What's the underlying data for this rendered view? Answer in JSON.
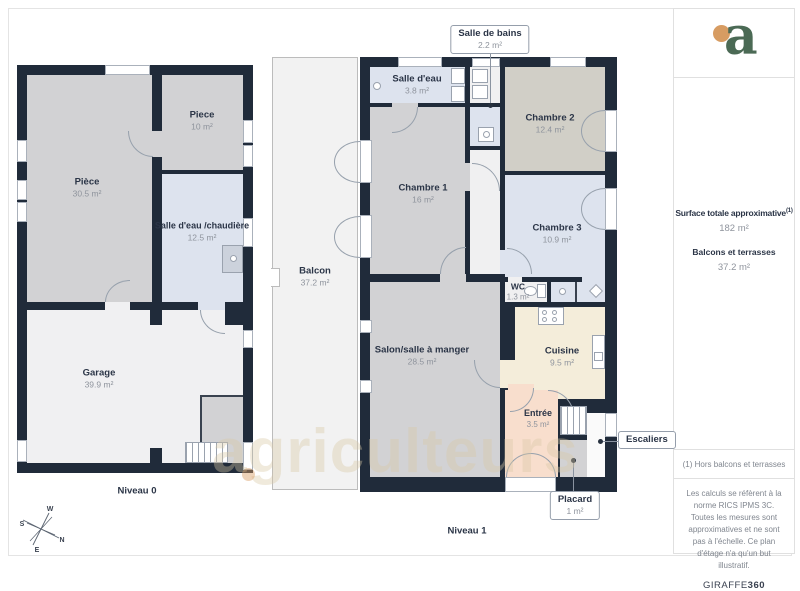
{
  "watermark": {
    "text": "agriculteurs"
  },
  "plans": {
    "niveau0": {
      "label": "Niveau 0",
      "rooms": {
        "piece_grande": {
          "name": "Pièce",
          "area": "30.5 m²"
        },
        "piece": {
          "name": "Piece",
          "area": "10 m²"
        },
        "salle_eau_chaudiere": {
          "name": "Salle d'eau /chaudière",
          "area": "12.5 m²"
        },
        "garage": {
          "name": "Garage",
          "area": "39.9 m²"
        }
      }
    },
    "niveau1": {
      "label": "Niveau 1",
      "rooms": {
        "balcon": {
          "name": "Balcon",
          "area": "37.2 m²"
        },
        "salle_eau": {
          "name": "Salle d'eau",
          "area": "3.8 m²"
        },
        "chambre1": {
          "name": "Chambre 1",
          "area": "16 m²"
        },
        "chambre2": {
          "name": "Chambre 2",
          "area": "12.4 m²"
        },
        "chambre3": {
          "name": "Chambre 3",
          "area": "10.9 m²"
        },
        "wc": {
          "name": "WC",
          "area": "1.3 m²"
        },
        "salon": {
          "name": "Salon/salle à manger",
          "area": "28.5 m²"
        },
        "cuisine": {
          "name": "Cuisine",
          "area": "9.5 m²"
        },
        "entree": {
          "name": "Entrée",
          "area": "3.5 m²"
        }
      },
      "callouts": {
        "salle_de_bains": {
          "name": "Salle de bains",
          "area": "2.2 m²"
        },
        "escaliers": {
          "name": "Escaliers"
        },
        "placard": {
          "name": "Placard",
          "area": "1 m²"
        }
      }
    }
  },
  "compass": {
    "w": "W",
    "s": "S",
    "n": "N",
    "e": "E"
  },
  "sidebar": {
    "logo_letter": "a",
    "surface_title": "Surface totale approximative",
    "surface_footnote_marker": "(1)",
    "surface_value": "182 m²",
    "balcony_title": "Balcons et terrasses",
    "balcony_value": "37.2 m²",
    "footnote": "(1) Hors balcons et terrasses",
    "legal": "Les calculs se réfèrent à la norme RICS IPMS 3C. Toutes les mesures sont approximatives et ne sont pas à l'échelle. Ce plan d'étage n'a qu'un but illustratif.",
    "brand_name": "GIRAFFE",
    "brand_suffix": "360"
  },
  "colors": {
    "wall": "#202b3a",
    "room_gray": "#d2d2d4",
    "room_beige_gray": "#d1cfc7",
    "room_blue": "#dde3ee",
    "room_cream": "#f4edda",
    "room_pink": "#f8decd",
    "room_light": "#f0f0f1",
    "logo_green": "#4b6a55",
    "logo_orange": "#d79c62"
  }
}
